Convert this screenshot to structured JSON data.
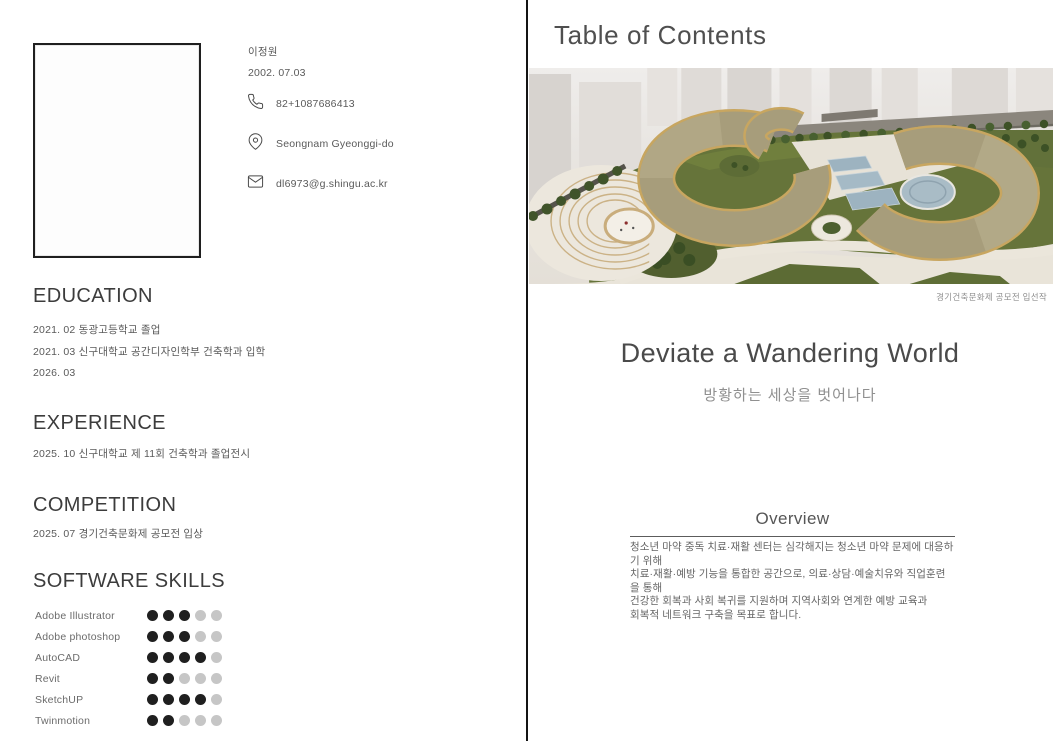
{
  "left": {
    "profile": {
      "name": "이정원",
      "birthdate": "2002. 07.03",
      "phone": "82+1087686413",
      "location": "Seongnam Gyeonggi-do",
      "email": "dl6973@g.shingu.ac.kr"
    },
    "education": {
      "title": "EDUCATION",
      "items": [
        "2021. 02 동광고등학교 졸업",
        "2021. 03 신구대학교 공간디자인학부 건축학과 입학",
        "2026. 03"
      ]
    },
    "experience": {
      "title": "EXPERIENCE",
      "items": [
        "2025. 10 신구대학교 제 11회 건축학과 졸업전시"
      ]
    },
    "competition": {
      "title": "COMPETITION",
      "items": [
        "2025. 07 경기건축문화제 공모전 입상"
      ]
    },
    "skills": {
      "title": "SOFTWARE SKILLS",
      "max_dots": 5,
      "dot_filled_color": "#1f1f1f",
      "dot_empty_color": "#c6c6c6",
      "items": [
        {
          "name": "Adobe Illustrator",
          "level": 3
        },
        {
          "name": "Adobe photoshop",
          "level": 3
        },
        {
          "name": "AutoCAD",
          "level": 4
        },
        {
          "name": "Revit",
          "level": 2
        },
        {
          "name": "SketchUP",
          "level": 4
        },
        {
          "name": "Twinmotion",
          "level": 2
        }
      ]
    }
  },
  "right": {
    "header": "Table of Contents",
    "render_caption": "경기건축문화제 공모전 입선작",
    "project_title": "Deviate a Wandering World",
    "project_subtitle": "방황하는 세상을 벗어나다",
    "overview": {
      "title": "Overview",
      "body": "청소년 마약 중독 치료·재활 센터는 심각해지는 청소년 마약 문제에 대응하기 위해\n치료·재활·예방 기능을 통합한 공간으로, 의료·상담·예술치유와 직업훈련을 통해\n건강한 회복과 사회 복귀를 지원하며 지역사회와 연계한 예방 교육과\n회복적 네트워크 구축을 목표로 합니다."
    }
  }
}
